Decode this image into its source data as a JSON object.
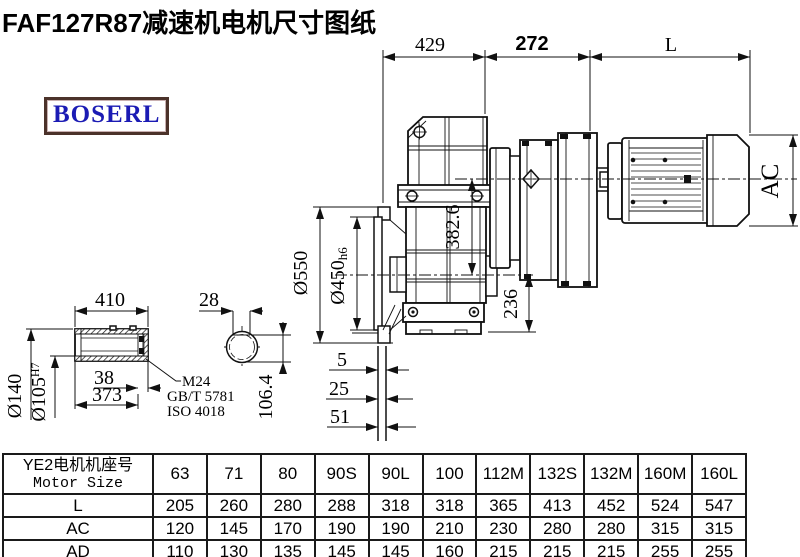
{
  "title": "FAF127R87减速机电机尺寸图纸",
  "logo": {
    "text": "BOSERL"
  },
  "colors": {
    "logo_text": "#1b1bb4",
    "logo_border": "#4b322a",
    "line": "#111111"
  },
  "drawing": {
    "dims": {
      "top_429": "429",
      "top_272": "272",
      "top_L": "L",
      "ac": "AC",
      "v382": "382.6",
      "v236": "236",
      "dia550": "Ø550",
      "dia450": "Ø450",
      "dia450_suffix": "h6",
      "gap5": "5",
      "gap25": "25",
      "gap51": "51",
      "shaft_len": "410",
      "key_width": "28",
      "dia140": "Ø140",
      "dia105": "Ø105",
      "dia105_sup": "H7",
      "len38": "38",
      "len373": "373",
      "thread": "M24",
      "std_gb": "GB/T 5781",
      "std_iso": "ISO 4018",
      "key_height": "106.4"
    }
  },
  "table": {
    "header_cn": "YE2电机机座号",
    "header_en": "Motor Size",
    "sizes": [
      "63",
      "71",
      "80",
      "90S",
      "90L",
      "100",
      "112M",
      "132S",
      "132M",
      "160M",
      "160L"
    ],
    "rows": [
      {
        "label": "L",
        "values": [
          "205",
          "260",
          "280",
          "288",
          "318",
          "318",
          "365",
          "413",
          "452",
          "524",
          "547"
        ]
      },
      {
        "label": "AC",
        "values": [
          "120",
          "145",
          "170",
          "190",
          "190",
          "210",
          "230",
          "280",
          "280",
          "315",
          "315"
        ]
      },
      {
        "label": "AD",
        "values": [
          "110",
          "130",
          "135",
          "145",
          "145",
          "160",
          "215",
          "215",
          "215",
          "255",
          "255"
        ]
      }
    ]
  }
}
